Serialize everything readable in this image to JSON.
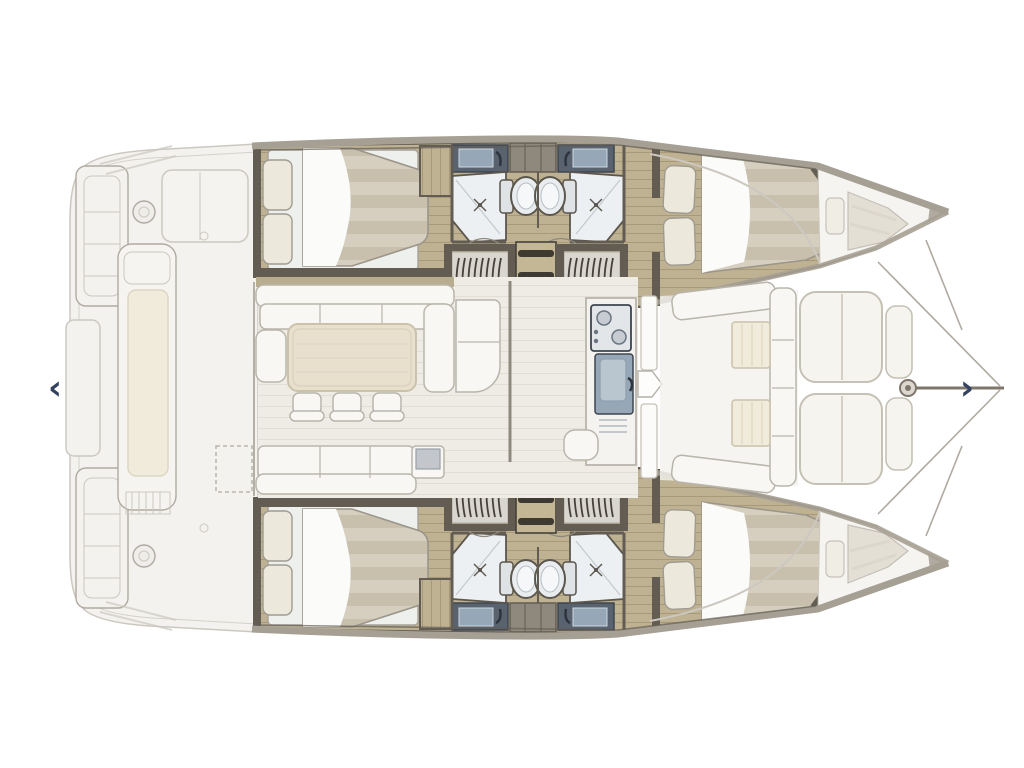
{
  "carousel": {
    "prev_icon": "‹",
    "next_icon": "›"
  },
  "colors": {
    "bg": "#ffffff",
    "ghost_fill": "#f4f2ef",
    "ghost_line": "#ccc8c0",
    "ghost_dark": "#b0aaa0",
    "deck": "#a6a094",
    "deck_dark": "#7e766a",
    "wall": "#625c52",
    "wall_dark": "#46423b",
    "wood": "#bfb293",
    "wood_line": "#a89a78",
    "floor_pale": "#efece6",
    "floor_line": "#e2ded6",
    "mattress": "#d6cfc0",
    "mattress_stripe": "#c8c0ad",
    "sheet": "#fbfbf9",
    "bedbase": "#eef0ee",
    "pillow": "#ece8dc",
    "pillow_line": "#a09b91",
    "sofa": "#f8f7f4",
    "sofa_line": "#b9b5ab",
    "cushion": "#f1ebdb",
    "shelf": "#b9ad90",
    "table": "#e8e0cd",
    "table_line": "#cbc2ac",
    "counter_navy": "#59626f",
    "steel": "#96a7b7",
    "steel_dark": "#3e4550",
    "fixture": "#edf0f2",
    "fixture_line": "#5b564e",
    "rib_bg": "#d9d6d0",
    "rib_dark": "#46423a",
    "ladder": "#c4b795",
    "ladder_bar": "#3e3931",
    "pad": "#f6f4ef",
    "pad_line": "#c6c1b5",
    "arrow": "#34425f"
  }
}
